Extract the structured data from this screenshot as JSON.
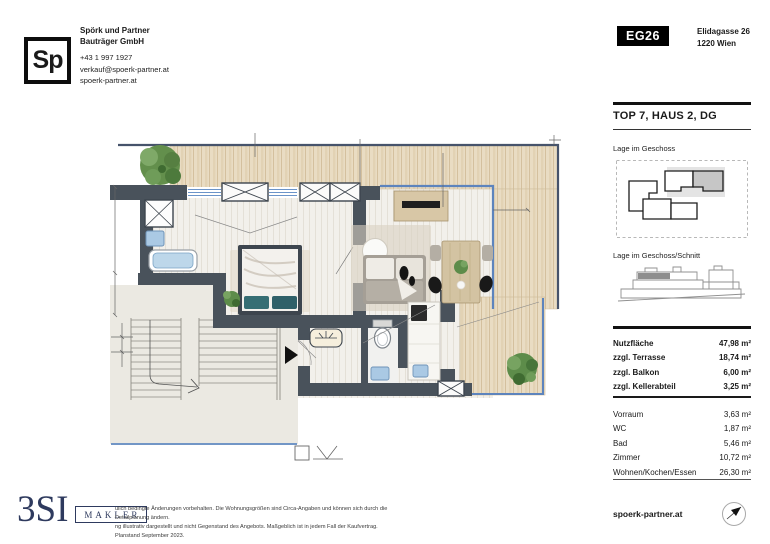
{
  "header": {
    "logo_text": "Sp",
    "company_line1": "Spörk und Partner",
    "company_line2": "Bauträger GmbH",
    "phone": "+43 1 997 1927",
    "email": "verkauf@spoerk-partner.at",
    "website": "spoerk-partner.at",
    "project_badge": "EG26",
    "address_line1": "Elidagasse 26",
    "address_line2": "1220 Wien"
  },
  "sidebar": {
    "title": "TOP 7, HAUS 2, DG",
    "location_label": "Lage im Geschoss",
    "section_label": "Lage im Geschoss/Schnitt",
    "areas": [
      {
        "label": "Nutzfläche",
        "value": "47,98 m²"
      },
      {
        "label": "zzgl. Terrasse",
        "value": "18,74 m²"
      },
      {
        "label": "zzgl. Balkon",
        "value": "6,00 m²"
      },
      {
        "label": "zzgl. Kellerabteil",
        "value": "3,25 m²"
      }
    ],
    "rooms": [
      {
        "label": "Vorraum",
        "value": "3,63 m²"
      },
      {
        "label": "WC",
        "value": "1,87 m²"
      },
      {
        "label": "Bad",
        "value": "5,46 m²"
      },
      {
        "label": "Zimmer",
        "value": "10,72 m²"
      },
      {
        "label": "Wohnen/Kochen/Essen",
        "value": "26,30 m²"
      }
    ]
  },
  "floor_plan": {
    "rooms_shown": [
      "Bad",
      "Zimmer",
      "Wohnen/Kochen/Essen",
      "Vorraum",
      "WC",
      "Terrasse",
      "Balkon",
      "Stiegenhaus"
    ],
    "colors": {
      "wall": "#49525b",
      "wood_deck": "#e9dcc3",
      "floor": "#f2f0eb",
      "glass_blue": "#5d84bd",
      "railing_blue": "#7296c6",
      "tree_green": "#5d8c4a",
      "pillow_teal": "#366e74",
      "highlight_gray": "#c6c6c6",
      "brand_navy": "#2e3a5e"
    }
  },
  "footer": {
    "brand": "3SI",
    "brand_suffix": "MAKLER",
    "disclaimer_line1": "ulich bedingte Änderungen vorbehalten. Die Wohnungsgrößen sind Circa-Angaben und können sich durch die Detailplanung ändern.",
    "disclaimer_line2": "ng illustrativ dargestellt und nicht Gegenstand des Angebots. Maßgeblich ist in jedem Fall der Kaufvertrag. Planstand September 2023.",
    "website": "spoerk-partner.at",
    "compass_icon": "north-arrow"
  }
}
